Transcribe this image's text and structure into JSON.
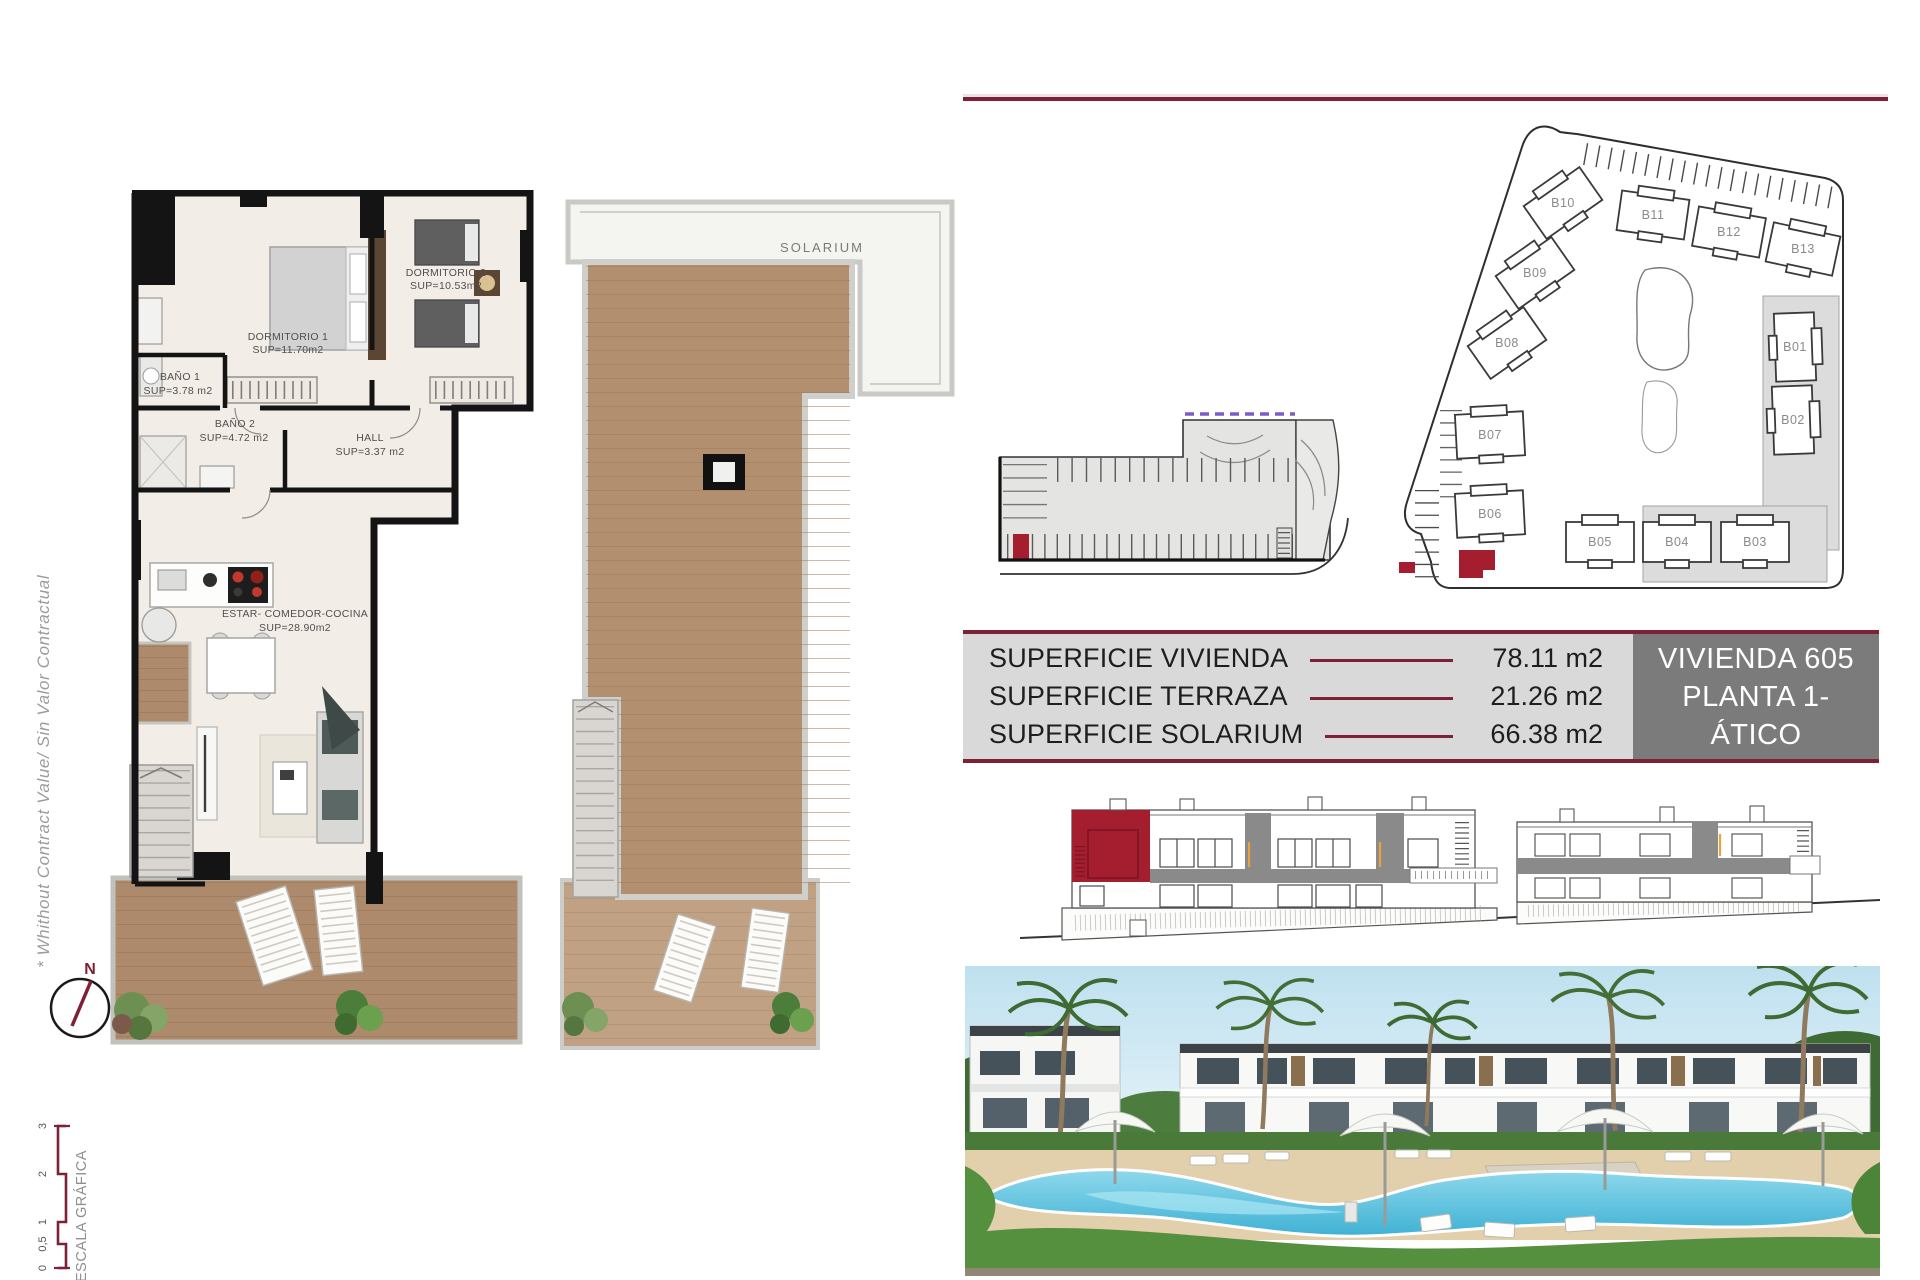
{
  "colors": {
    "accent_maroon": "#7d2236",
    "highlight_red": "#a51e30",
    "panel_gray": "#7b7b7b",
    "table_bg": "#d9d9d9",
    "purple_dash": "#7c5cc8",
    "wood": "#b08a68"
  },
  "side_rail": {
    "disclaimer": "* Whithout Contract Value/ Sin Valor Contractual",
    "compass_n": "N",
    "scale_title": "ESCALA GRÁFICA",
    "scale_ticks": [
      "0",
      "0,5",
      "1",
      "2",
      "3"
    ]
  },
  "floor_plan": {
    "rooms": [
      {
        "name": "DORMITORIO 1",
        "sup": "SUP=11.70m2"
      },
      {
        "name": "DORMITORIO 2",
        "sup": "SUP=10.53m2"
      },
      {
        "name": "BAÑO 1",
        "sup": "SUP=3.78 m2"
      },
      {
        "name": "BAÑO 2",
        "sup": "SUP=4.72 m2"
      },
      {
        "name": "HALL",
        "sup": "SUP=3.37 m2"
      },
      {
        "name": "ESTAR-  COMEDOR-COCINA",
        "sup": "SUP=28.90m2"
      }
    ]
  },
  "solarium_plan": {
    "label": "SOLARIUM"
  },
  "site_plan": {
    "buildings": [
      "B01",
      "B02",
      "B03",
      "B04",
      "B05",
      "B06",
      "B07",
      "B08",
      "B09",
      "B10",
      "B11",
      "B12",
      "B13"
    ]
  },
  "summary_table": {
    "rows": [
      {
        "label": "SUPERFICIE VIVIENDA",
        "value": "78.11 m2"
      },
      {
        "label": "SUPERFICIE TERRAZA",
        "value": "21.26 m2"
      },
      {
        "label": "SUPERFICIE SOLARIUM",
        "value": "66.38 m2"
      }
    ],
    "unit_line1": "VIVIENDA 605",
    "unit_line2": "PLANTA 1- ÁTICO"
  }
}
